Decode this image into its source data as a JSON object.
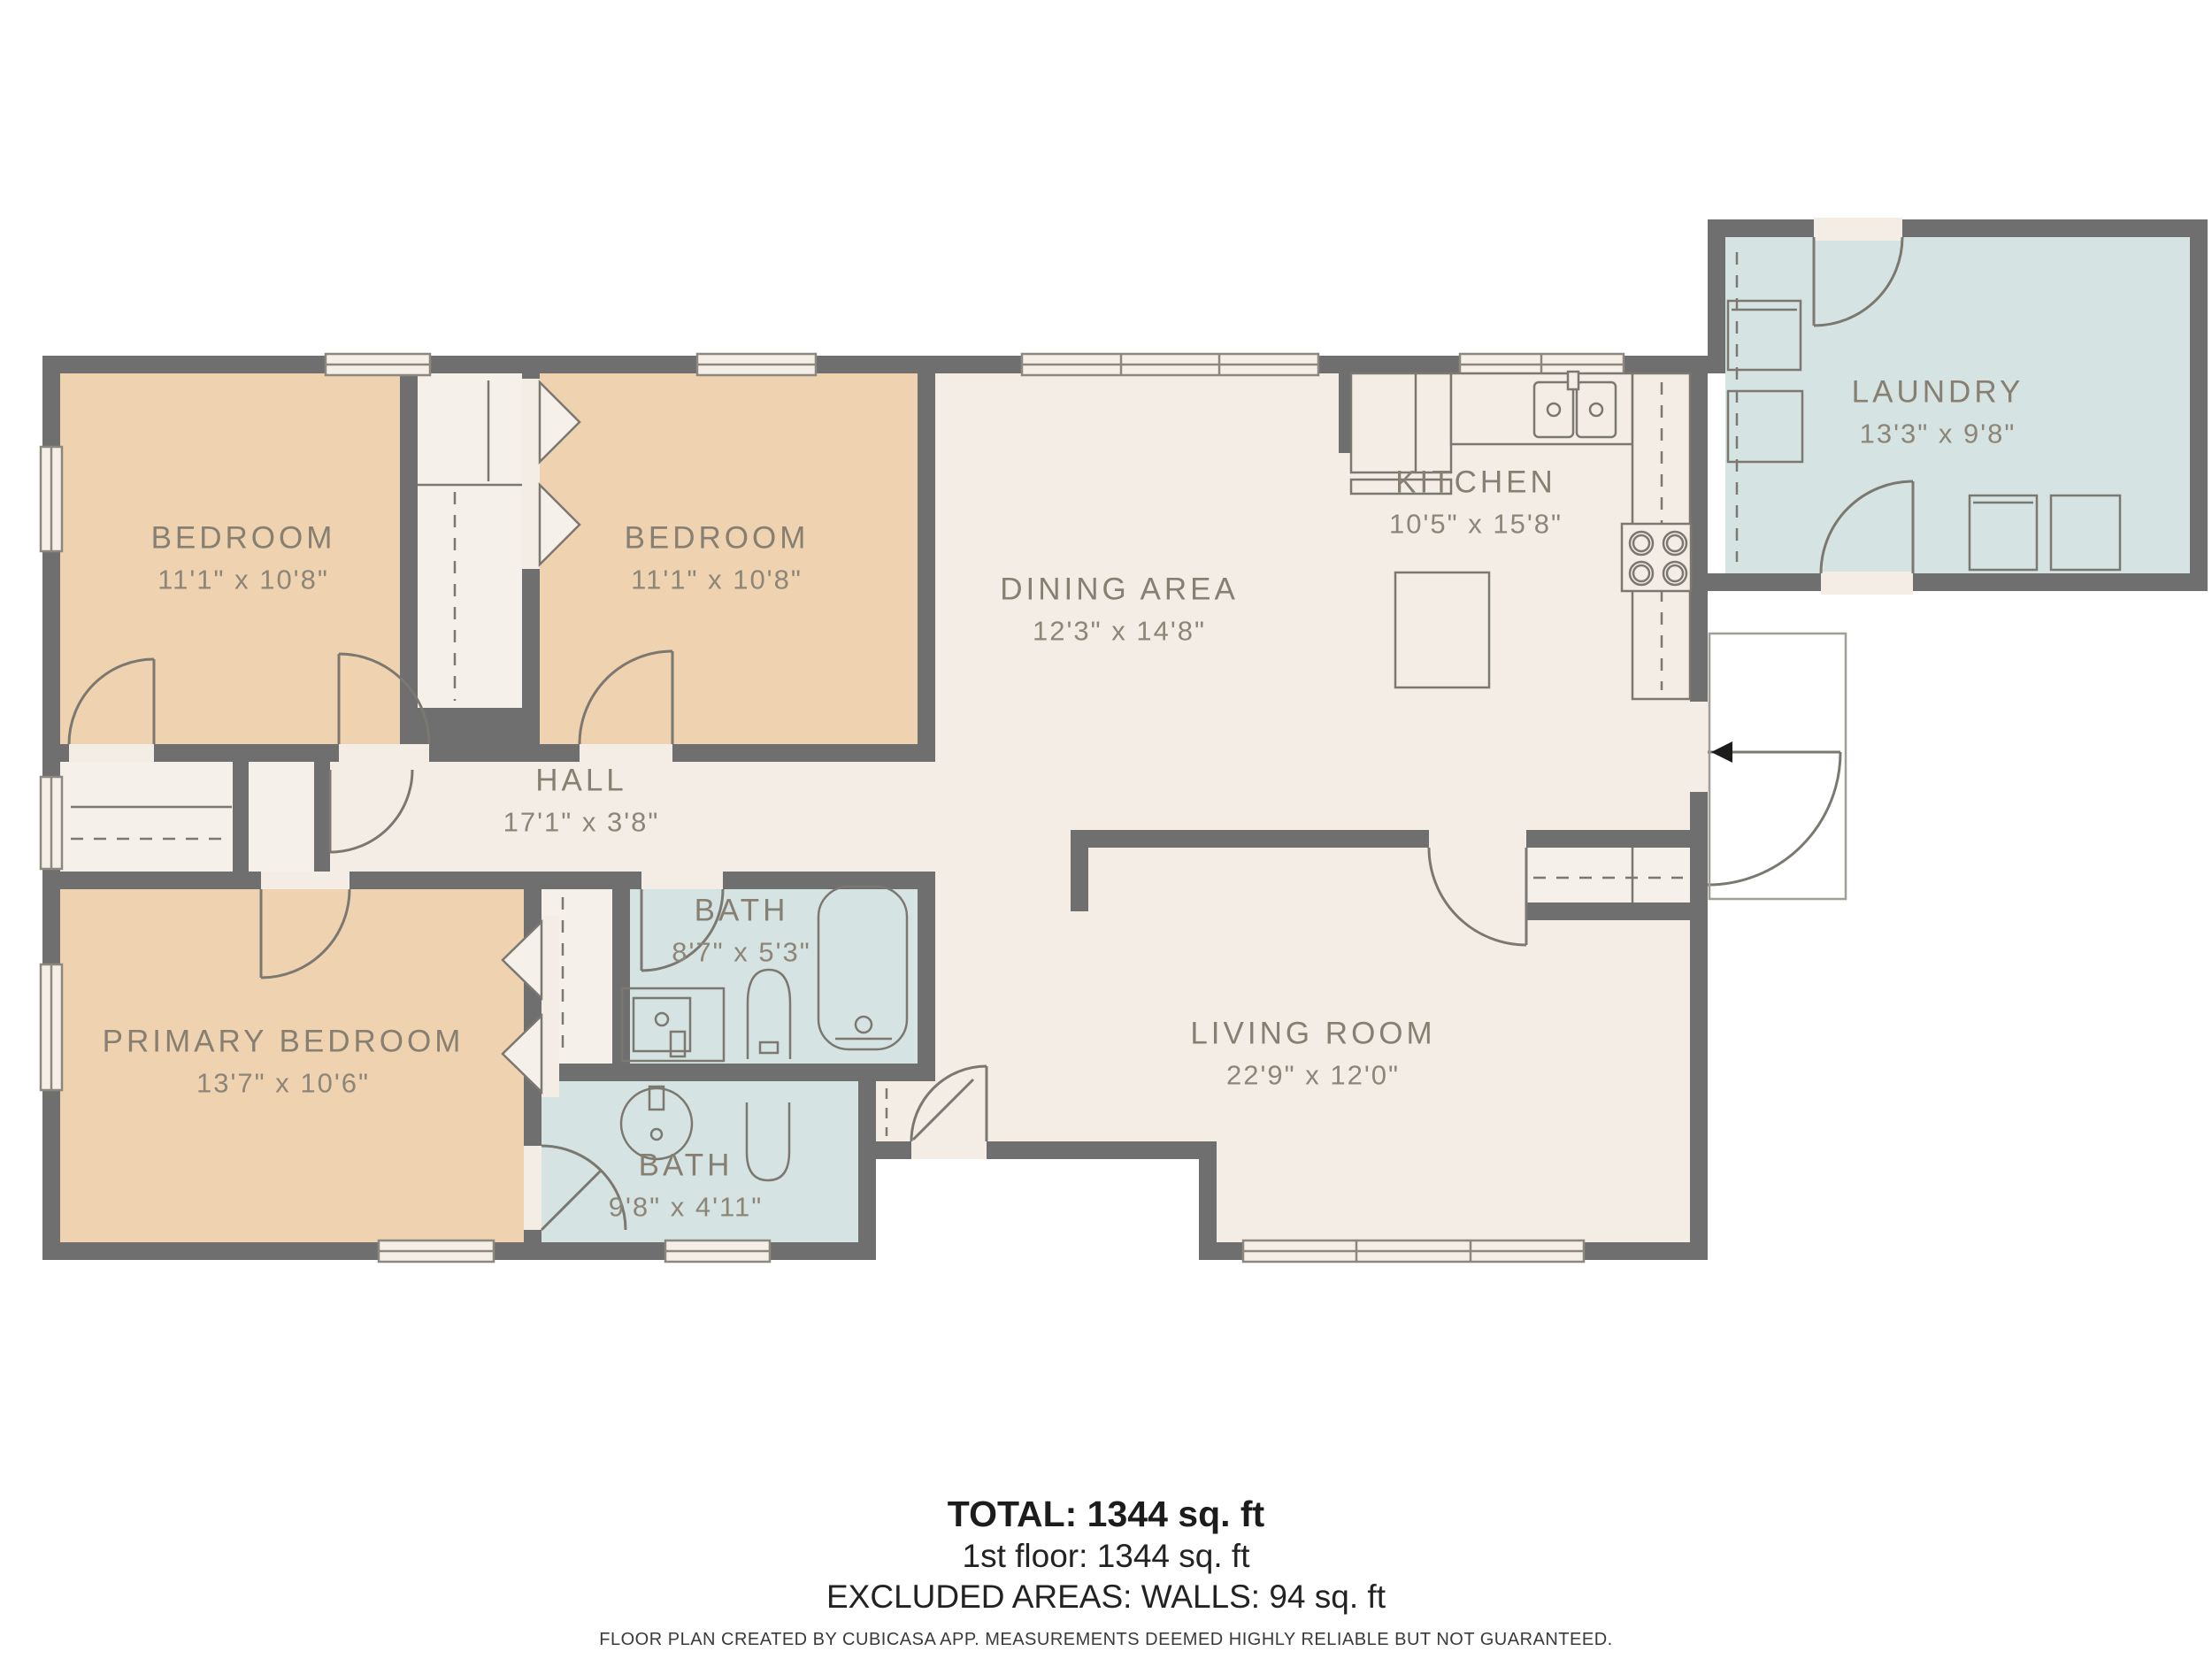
{
  "colors": {
    "wall": "#6f6f6f",
    "floor_warm": "#f3ede5",
    "floor_peach": "#efd2b0",
    "floor_blue": "#d5e4e2",
    "closet": "#f5f0e9",
    "window_fill": "#f6efe7",
    "outline": "#7b7871",
    "label_text": "#877f72"
  },
  "rooms": [
    {
      "id": "bedroom-1",
      "name": "BEDROOM",
      "dims": "11'1\" x 10'8\""
    },
    {
      "id": "bedroom-2",
      "name": "BEDROOM",
      "dims": "11'1\" x 10'8\""
    },
    {
      "id": "dining-area",
      "name": "DINING AREA",
      "dims": "12'3\" x 14'8\""
    },
    {
      "id": "kitchen",
      "name": "KITCHEN",
      "dims": "10'5\" x 15'8\""
    },
    {
      "id": "laundry",
      "name": "LAUNDRY",
      "dims": "13'3\" x 9'8\""
    },
    {
      "id": "hall",
      "name": "HALL",
      "dims": "17'1\" x 3'8\""
    },
    {
      "id": "primary-bedroom",
      "name": "PRIMARY BEDROOM",
      "dims": "13'7\" x 10'6\""
    },
    {
      "id": "bath-1",
      "name": "BATH",
      "dims": "8'7\" x 5'3\""
    },
    {
      "id": "bath-2",
      "name": "BATH",
      "dims": "9'8\" x 4'11\""
    },
    {
      "id": "living-room",
      "name": "LIVING ROOM",
      "dims": "22'9\" x 12'0\""
    }
  ],
  "summary": {
    "total": "TOTAL: 1344 sq. ft",
    "first_floor": "1st floor: 1344 sq. ft",
    "excluded": "EXCLUDED AREAS: WALLS: 94 sq. ft"
  },
  "disclaimer": "FLOOR PLAN CREATED BY CUBICASA APP. MEASUREMENTS DEEMED HIGHLY RELIABLE BUT NOT GUARANTEED."
}
